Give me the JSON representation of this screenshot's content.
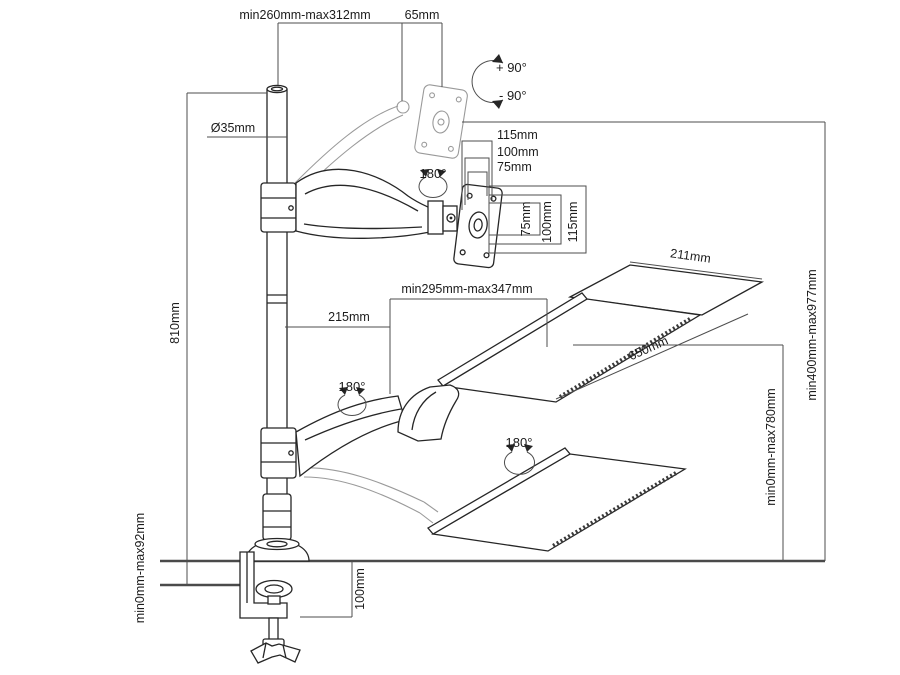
{
  "diagram": {
    "labels": {
      "top_span": "min260mm-max312mm",
      "top_offset": "65mm",
      "tilt_up": "+ 90°",
      "tilt_down": "- 90°",
      "pole_diameter": "Ø35mm",
      "pole_height": "810mm",
      "rotation_monitor": "180°",
      "rotation_pole": "180°",
      "rotation_tray": "180°",
      "vesa_width_115": "115mm",
      "vesa_width_100": "100mm",
      "vesa_width_75": "75mm",
      "vesa_height_75": "75mm",
      "vesa_height_100": "100mm",
      "vesa_height_115": "115mm",
      "arm_inner_span": "215mm",
      "arm_outer_span": "min295mm-max347mm",
      "tray_depth": "211mm",
      "tray_width": "650mm",
      "height_range": "min400mm-max977mm",
      "tray_travel_range": "min0mm-max780mm",
      "desk_thickness_range": "min0mm-max92mm",
      "clamp_height": "100mm"
    }
  }
}
